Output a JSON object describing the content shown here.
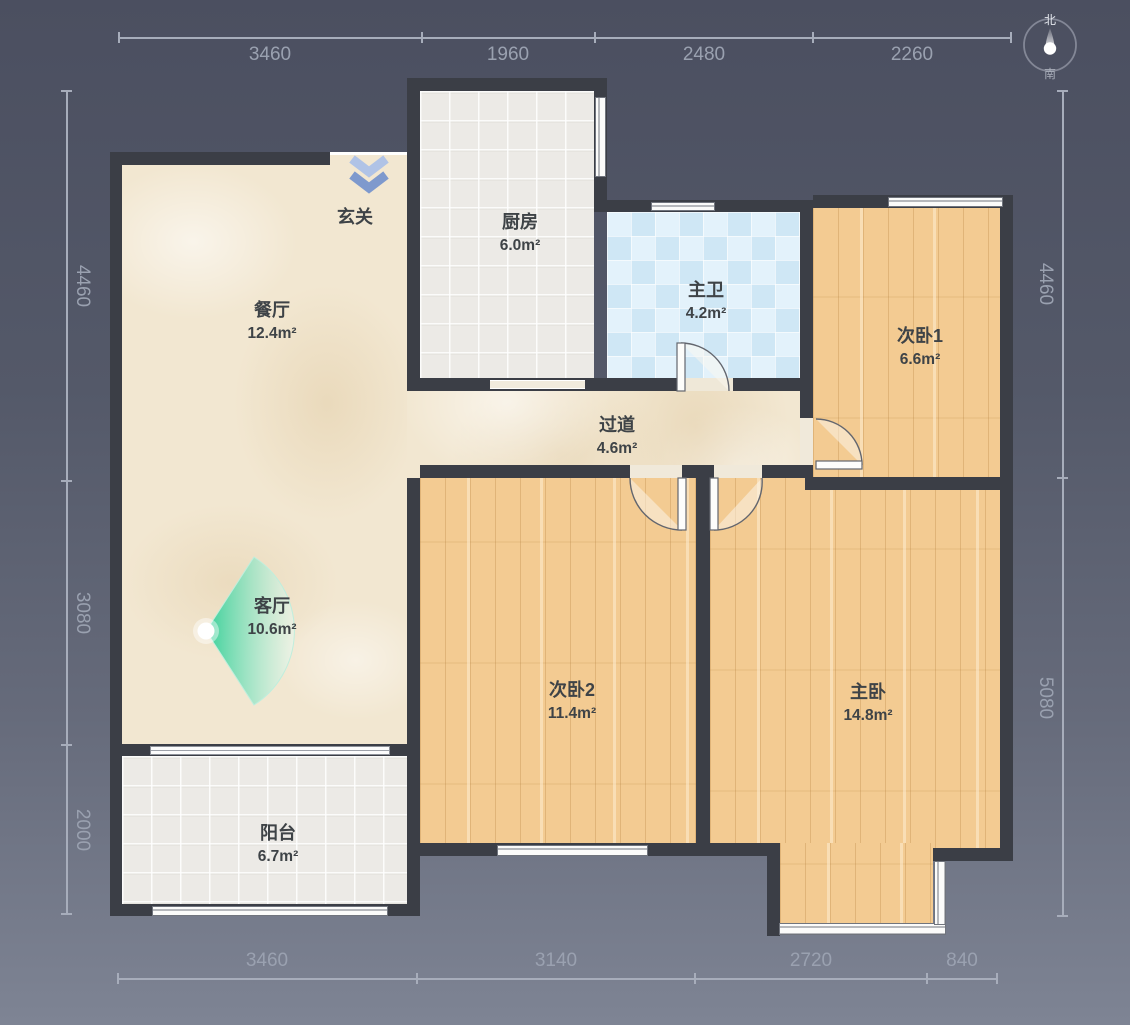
{
  "compass": {
    "north": "北",
    "south": "南"
  },
  "rooms": {
    "entrance": {
      "name": "玄关",
      "area": ""
    },
    "kitchen": {
      "name": "厨房",
      "area": "6.0m²"
    },
    "bathroom": {
      "name": "主卫",
      "area": "4.2m²"
    },
    "bedroom1": {
      "name": "次卧1",
      "area": "6.6m²"
    },
    "dining": {
      "name": "餐厅",
      "area": "12.4m²"
    },
    "hallway": {
      "name": "过道",
      "area": "4.6m²"
    },
    "living": {
      "name": "客厅",
      "area": "10.6m²"
    },
    "bedroom2": {
      "name": "次卧2",
      "area": "11.4m²"
    },
    "master": {
      "name": "主卧",
      "area": "14.8m²"
    },
    "balcony": {
      "name": "阳台",
      "area": "6.7m²"
    }
  },
  "dims": {
    "top": [
      "3460",
      "1960",
      "2480",
      "2260"
    ],
    "bottom": [
      "3460",
      "3140",
      "2720",
      "840"
    ],
    "left": [
      "4460",
      "3080",
      "2000"
    ],
    "right": [
      "4460",
      "5080"
    ]
  },
  "colors": {
    "background_top": "#4b4f60",
    "background_bottom": "#7d8393",
    "wall": "#3b3e46",
    "marble_floor": "#f2e7d1",
    "tile_floor": "#eceae6",
    "bath_tile": "#dbeef9",
    "wood_floor": "#f3cb92",
    "camera_fan_green": "#3fd09c",
    "entry_arrow_blue": "#8fa9d8",
    "dimension_text": "#9aa1b0"
  }
}
